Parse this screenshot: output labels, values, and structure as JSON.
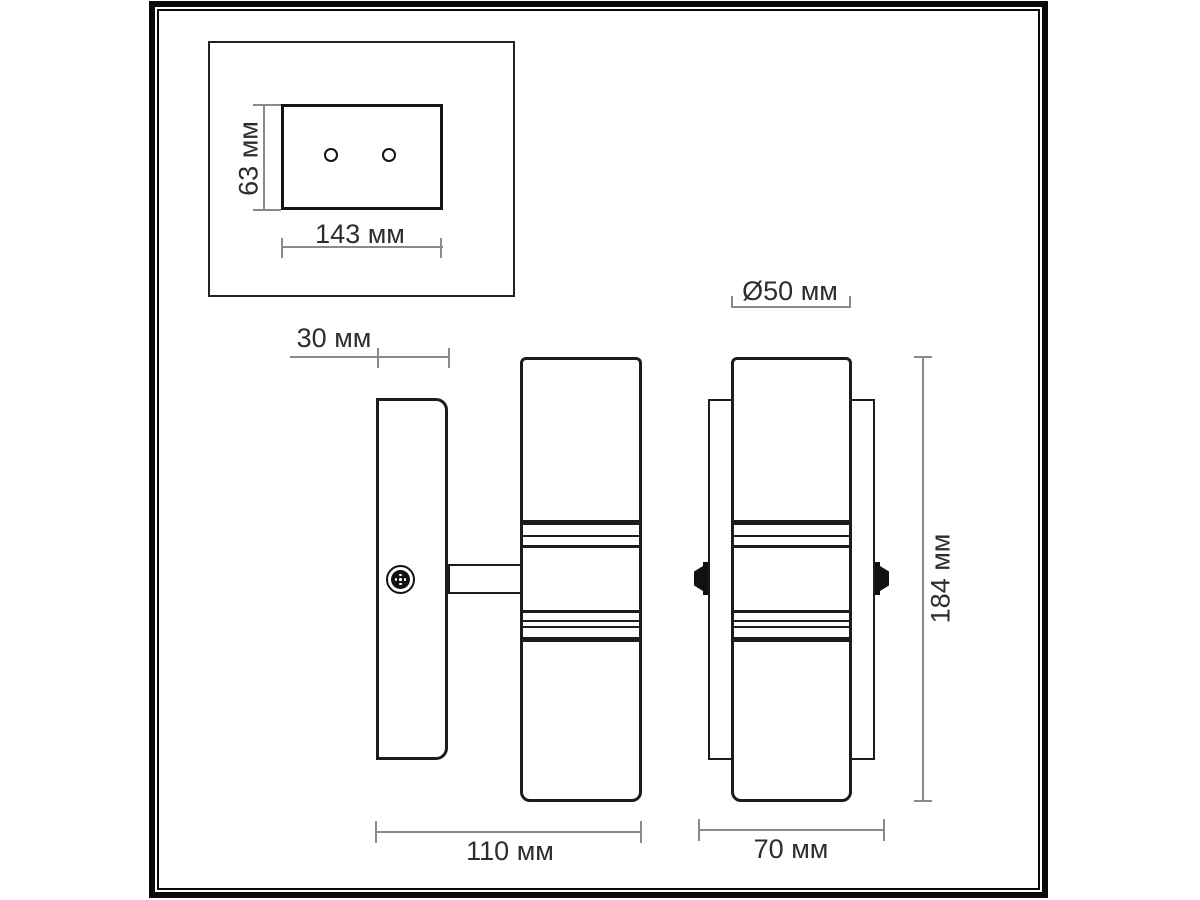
{
  "drawing": {
    "type": "technical-dimension-drawing",
    "subject": "two-lamp wall sconce, three orthographic views"
  },
  "colors": {
    "background": "#ffffff",
    "outline": "#1c1c1c",
    "frame": "#0a0a0a",
    "dimension_line": "#8a8a8a",
    "label_text": "#2d2d2d"
  },
  "views": {
    "mounting_plate_plan": {
      "holes_count": 2,
      "height": {
        "label": "63 мм",
        "value_mm": 63
      },
      "width": {
        "label": "143 мм",
        "value_mm": 143
      }
    },
    "side_view": {
      "wall_plate_depth": {
        "label": "30 мм",
        "value_mm": 30
      },
      "total_depth": {
        "label": "110 мм",
        "value_mm": 110
      }
    },
    "front_view": {
      "shade_diameter": {
        "label": "Ø50 мм",
        "value_mm": 50
      },
      "total_height": {
        "label": "184 мм",
        "value_mm": 184
      },
      "shade_width": {
        "label": "70 мм",
        "value_mm": 70
      }
    }
  }
}
